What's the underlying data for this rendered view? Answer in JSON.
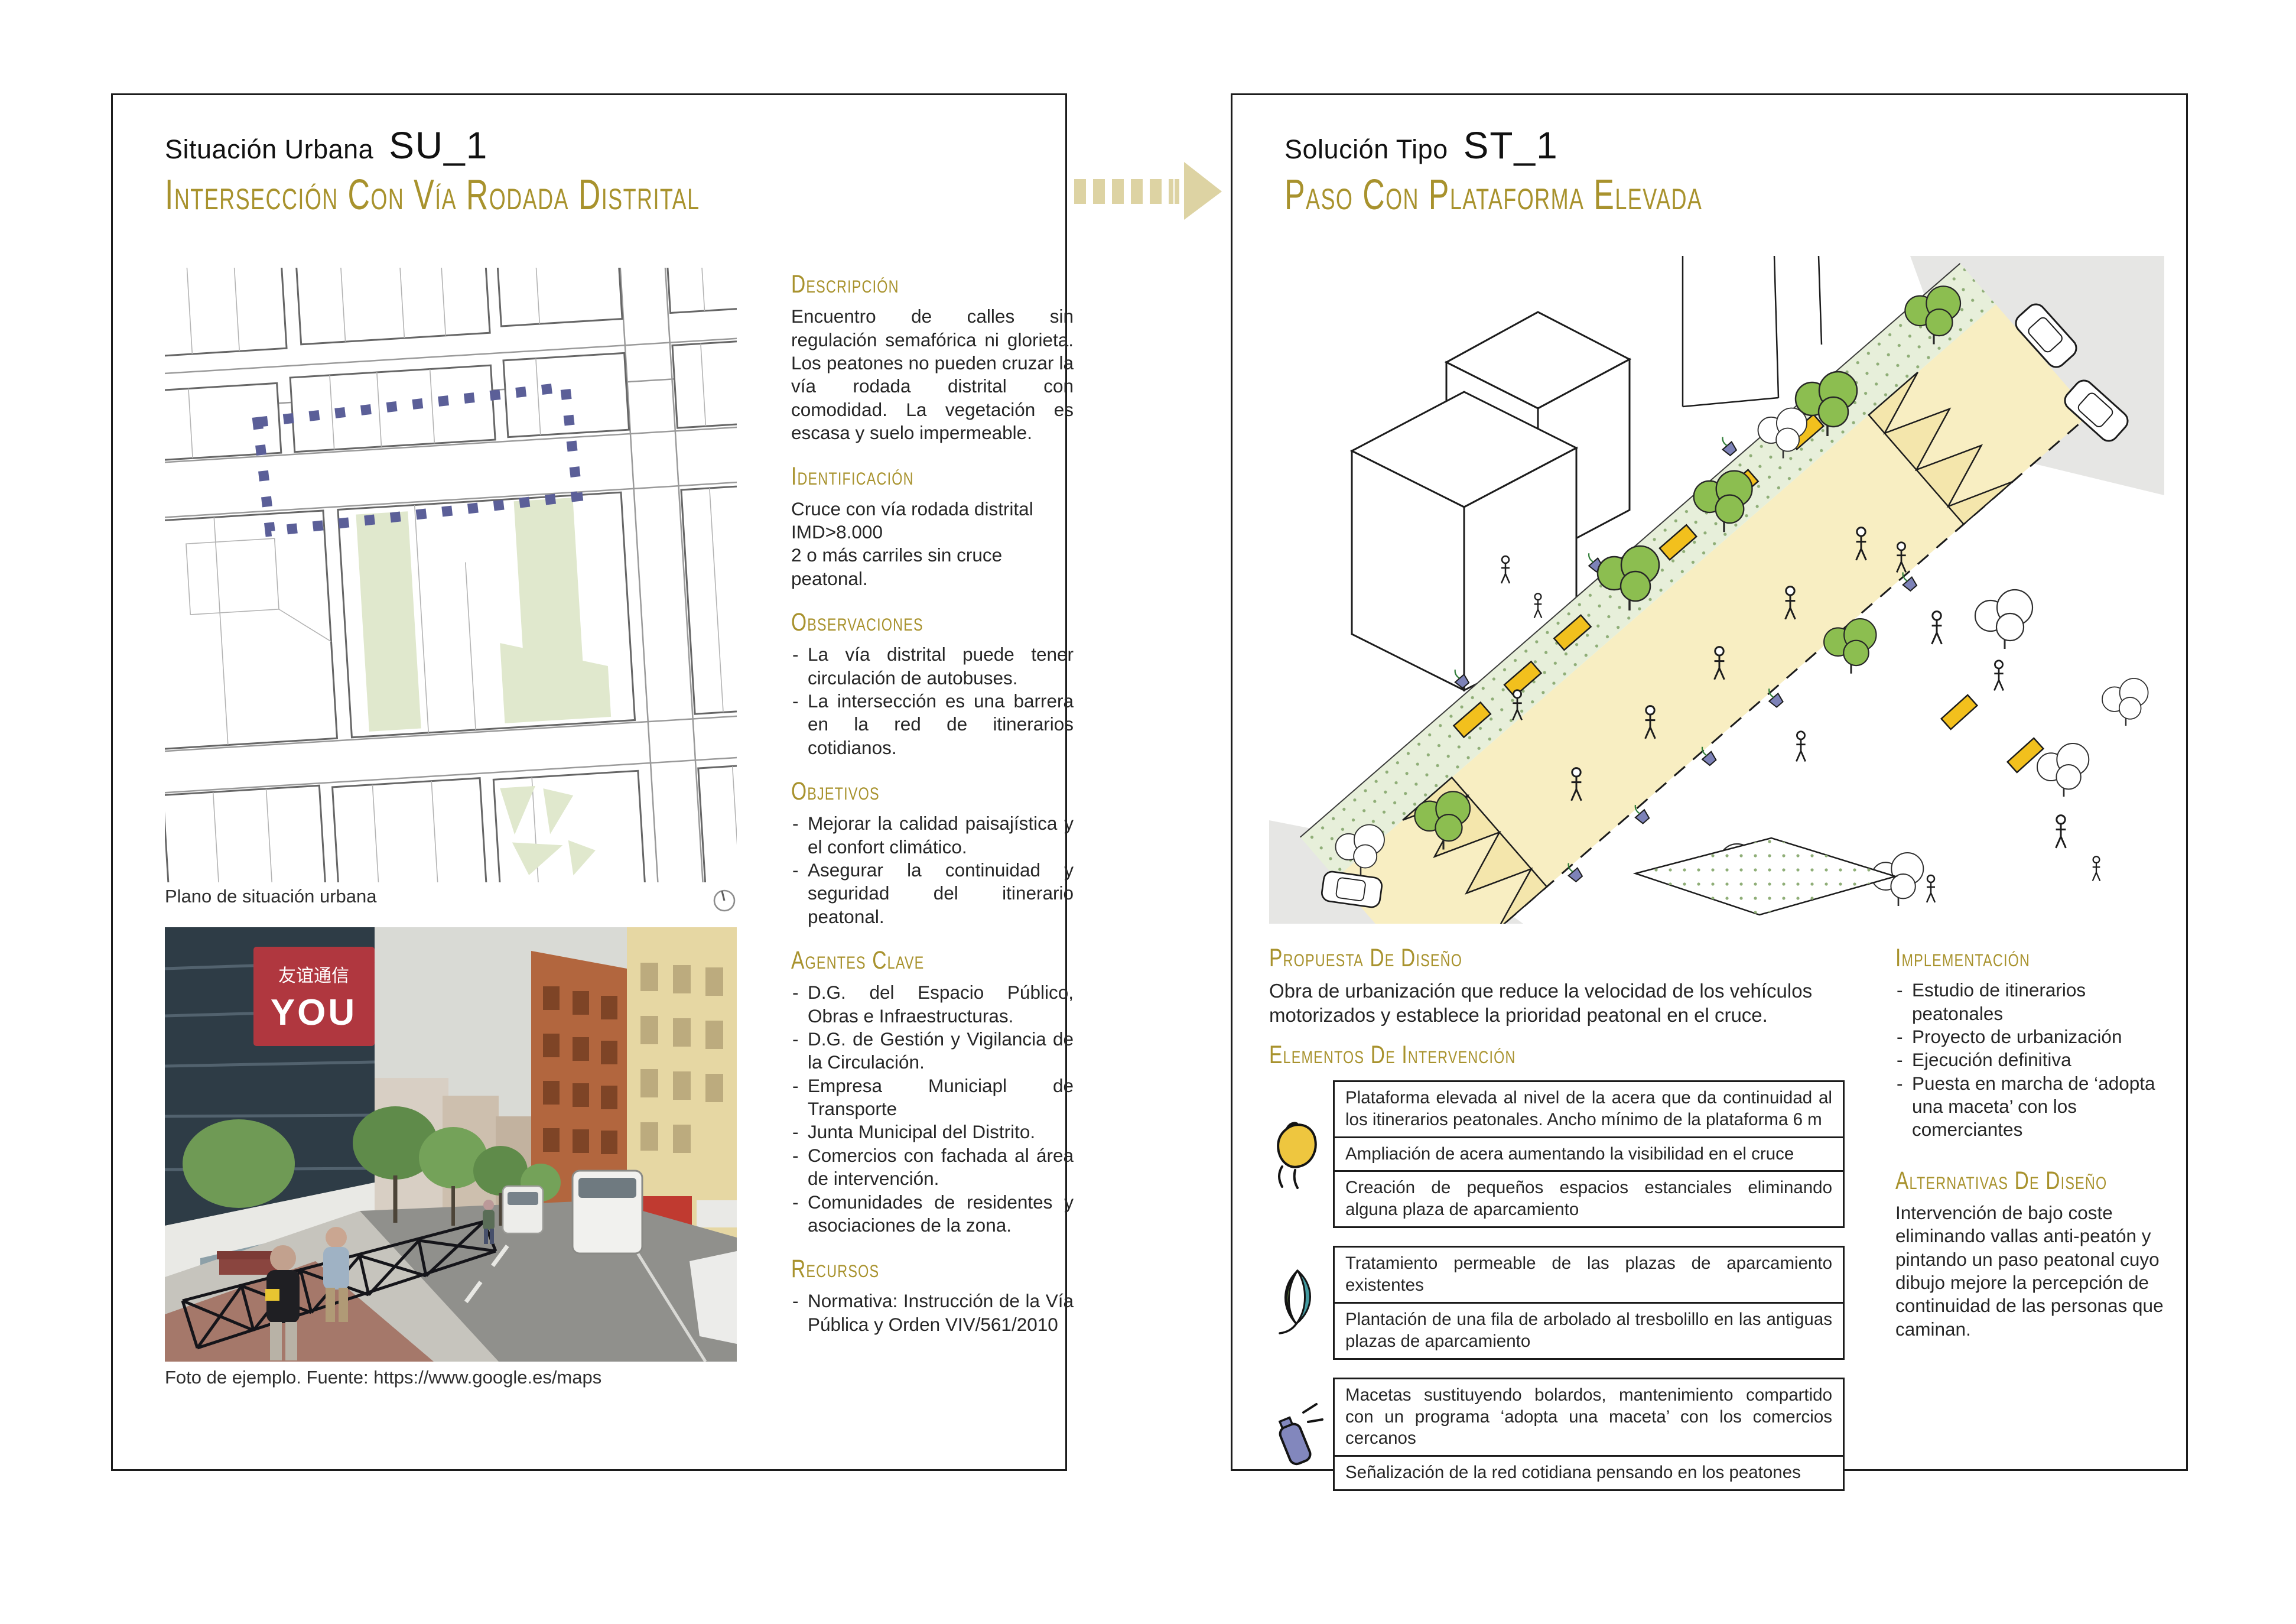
{
  "colors": {
    "accent_ochre": "#a8922d",
    "dash_purple": "#5b5f98",
    "arrow_beige": "#ddd3a3",
    "bench_yellow": "#f2c01d",
    "tree_green": "#8cbe50",
    "leaf_teal": "#449ba1",
    "spray_purple": "#8287bd",
    "hand_yellow": "#eec63f"
  },
  "arrow": {
    "icon": "dashed-right-arrow-icon"
  },
  "left_panel": {
    "kicker": "Situación Urbana",
    "code": "SU_1",
    "title": "Intersección con vía rodada distrital",
    "map": {
      "caption": "Plano de situación urbana",
      "icon": "north-compass-icon"
    },
    "photo": {
      "caption": "Foto de ejemplo. Fuente: https://www.google.es/maps",
      "sign_cjk": "友谊通信",
      "sign_brand": "YOU"
    },
    "sections": {
      "descripcion": {
        "heading": "Descripción",
        "body": "Encuentro de calles sin regulación semafórica ni glorieta. Los peatones no pueden cruzar la vía rodada distrital con comodidad. La vegetación es escasa y suelo impermeable."
      },
      "identificacion": {
        "heading": "Identificación",
        "lines": [
          "Cruce con vía rodada distrital",
          "IMD>8.000",
          "2 o más carriles sin cruce peatonal."
        ]
      },
      "observaciones": {
        "heading": "Observaciones",
        "items": [
          "La vía distrital puede tener circulación de autobuses.",
          "La intersección es una barrera en la red de itinerarios cotidianos."
        ]
      },
      "objetivos": {
        "heading": "Objetivos",
        "items": [
          "Mejorar la calidad paisajística y el confort climático.",
          "Asegurar la continuidad y seguridad del itinerario peatonal."
        ]
      },
      "agentes": {
        "heading": "Agentes clave",
        "items": [
          "D.G. del Espacio Público, Obras e Infraestructuras.",
          "D.G. de Gestión y Vigilancia de la Circulación.",
          "Empresa Municiapl de Transporte",
          "Junta Municipal del Distrito.",
          "Comercios con fachada al área de intervención.",
          "Comunidades de residentes y asociaciones de la zona."
        ]
      },
      "recursos": {
        "heading": "Recursos",
        "items": [
          "Normativa: Instrucción de la Vía Pública y Orden VIV/561/2010"
        ]
      }
    }
  },
  "right_panel": {
    "kicker": "Solución Tipo",
    "code": "ST_1",
    "title": "Paso con plataforma elevada",
    "propuesta": {
      "heading": "Propuesta de diseño",
      "body": "Obra de urbanización que reduce la velocidad de los vehículos motorizados y establece la prioridad peatonal en el cruce."
    },
    "elementos": {
      "heading": "Elementos de intervención",
      "groups": [
        {
          "icon": "hand-icon",
          "boxes": [
            "Plataforma elevada al nivel de la acera que da continuidad al los itinerarios peatonales. Ancho mínimo de la plataforma 6 m",
            "Ampliación de acera aumentando la visibilidad en el cruce",
            "Creación de pequeños espacios estanciales eliminando alguna plaza de aparcamiento"
          ]
        },
        {
          "icon": "leaf-icon",
          "boxes": [
            "Tratamiento permeable de las plazas de aparcamiento existentes",
            "Plantación de una fila de arbolado al tresbolillo en las antiguas plazas de aparcamiento"
          ]
        },
        {
          "icon": "spray-can-icon",
          "boxes": [
            "Macetas sustituyendo bolardos, mantenimiento compartido con un programa ‘adopta una maceta’ con los comercios cercanos",
            "Señalización de la red cotidiana pensando en los peatones"
          ]
        }
      ]
    },
    "implementacion": {
      "heading": "Implementación",
      "items": [
        "Estudio de itinerarios peatonales",
        "Proyecto de urbanización",
        "Ejecución definitiva",
        "Puesta en marcha de ‘adopta una maceta’ con los comerciantes"
      ]
    },
    "alternativas": {
      "heading": "Alternativas de diseño",
      "body": "Intervención de bajo coste eliminando vallas anti-peatón y pintando un paso peatonal cuyo dibujo mejore la percepción de continuidad de las personas que caminan."
    }
  }
}
